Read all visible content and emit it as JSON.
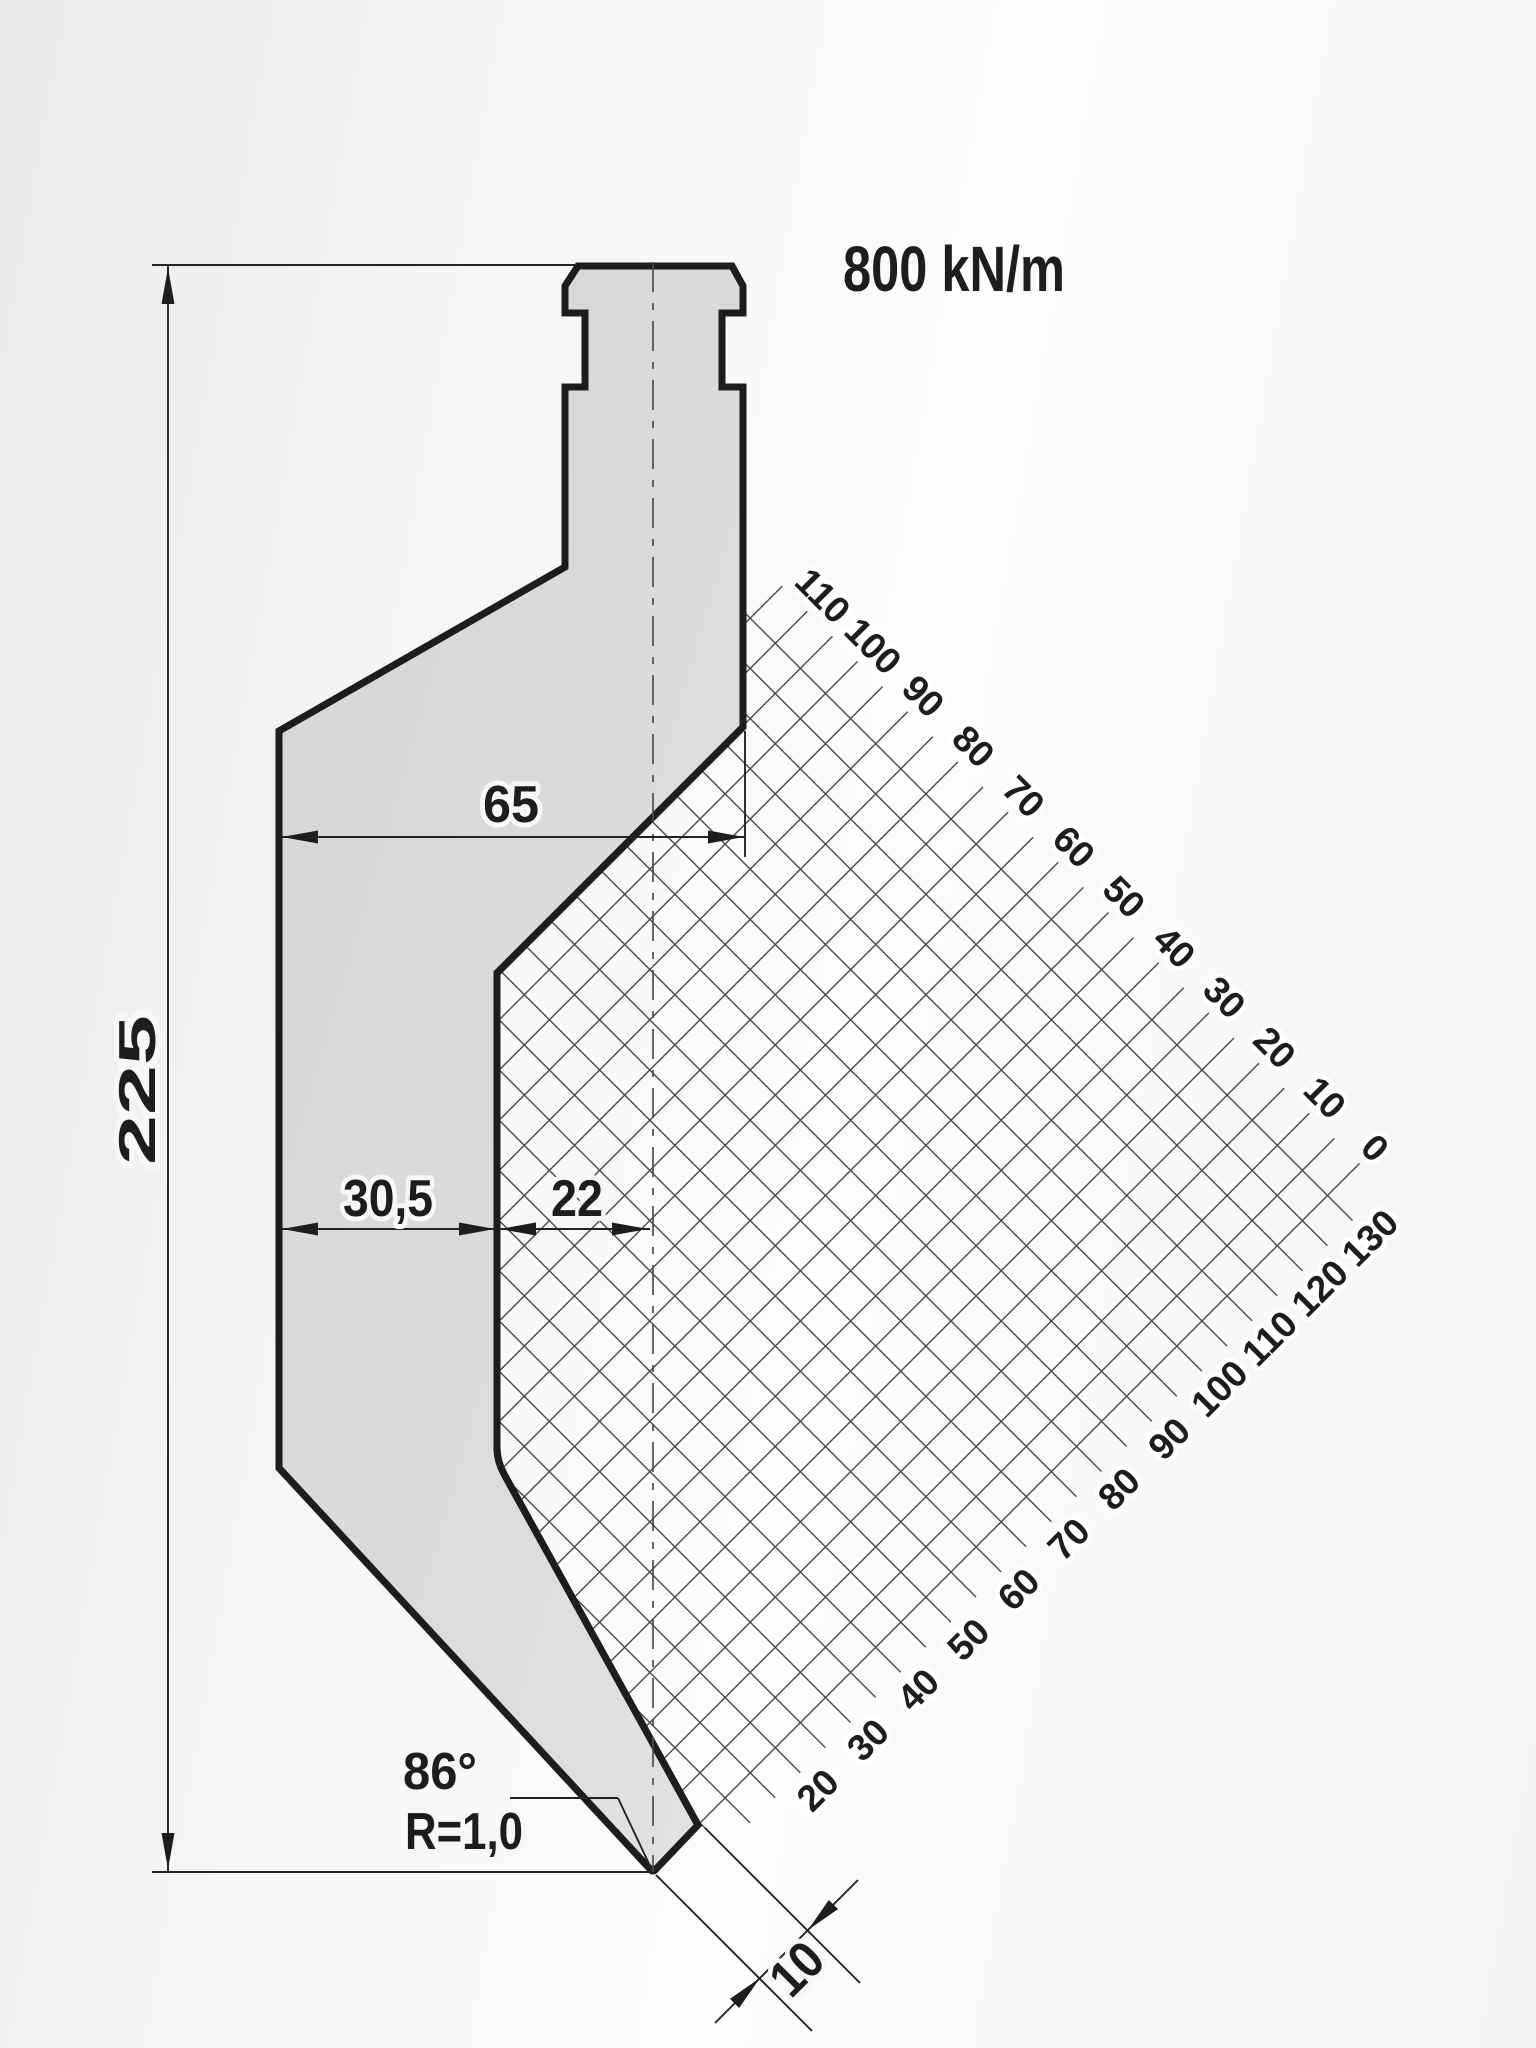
{
  "drawing": {
    "force_rating": "800 kN/m",
    "dimensions": {
      "total_height": "225",
      "shoulder_width": "65",
      "body_width": "30,5",
      "throat_offset": "22",
      "tip_flat": "10",
      "tip_angle": "86°",
      "tip_radius": "R=1,0"
    },
    "clearance_grid": {
      "top_scale": [
        "110",
        "100",
        "90",
        "80",
        "70",
        "60",
        "50",
        "40",
        "30",
        "20",
        "10",
        "0"
      ],
      "bottom_scale": [
        "20",
        "30",
        "40",
        "50",
        "60",
        "70",
        "80",
        "90",
        "100",
        "110",
        "120",
        "130"
      ]
    },
    "colors": {
      "outline": "#1d1d1b",
      "punch_fill": "#d9d9d8",
      "grid_line": "#4a4a48",
      "text": "#1d1d1b"
    }
  }
}
